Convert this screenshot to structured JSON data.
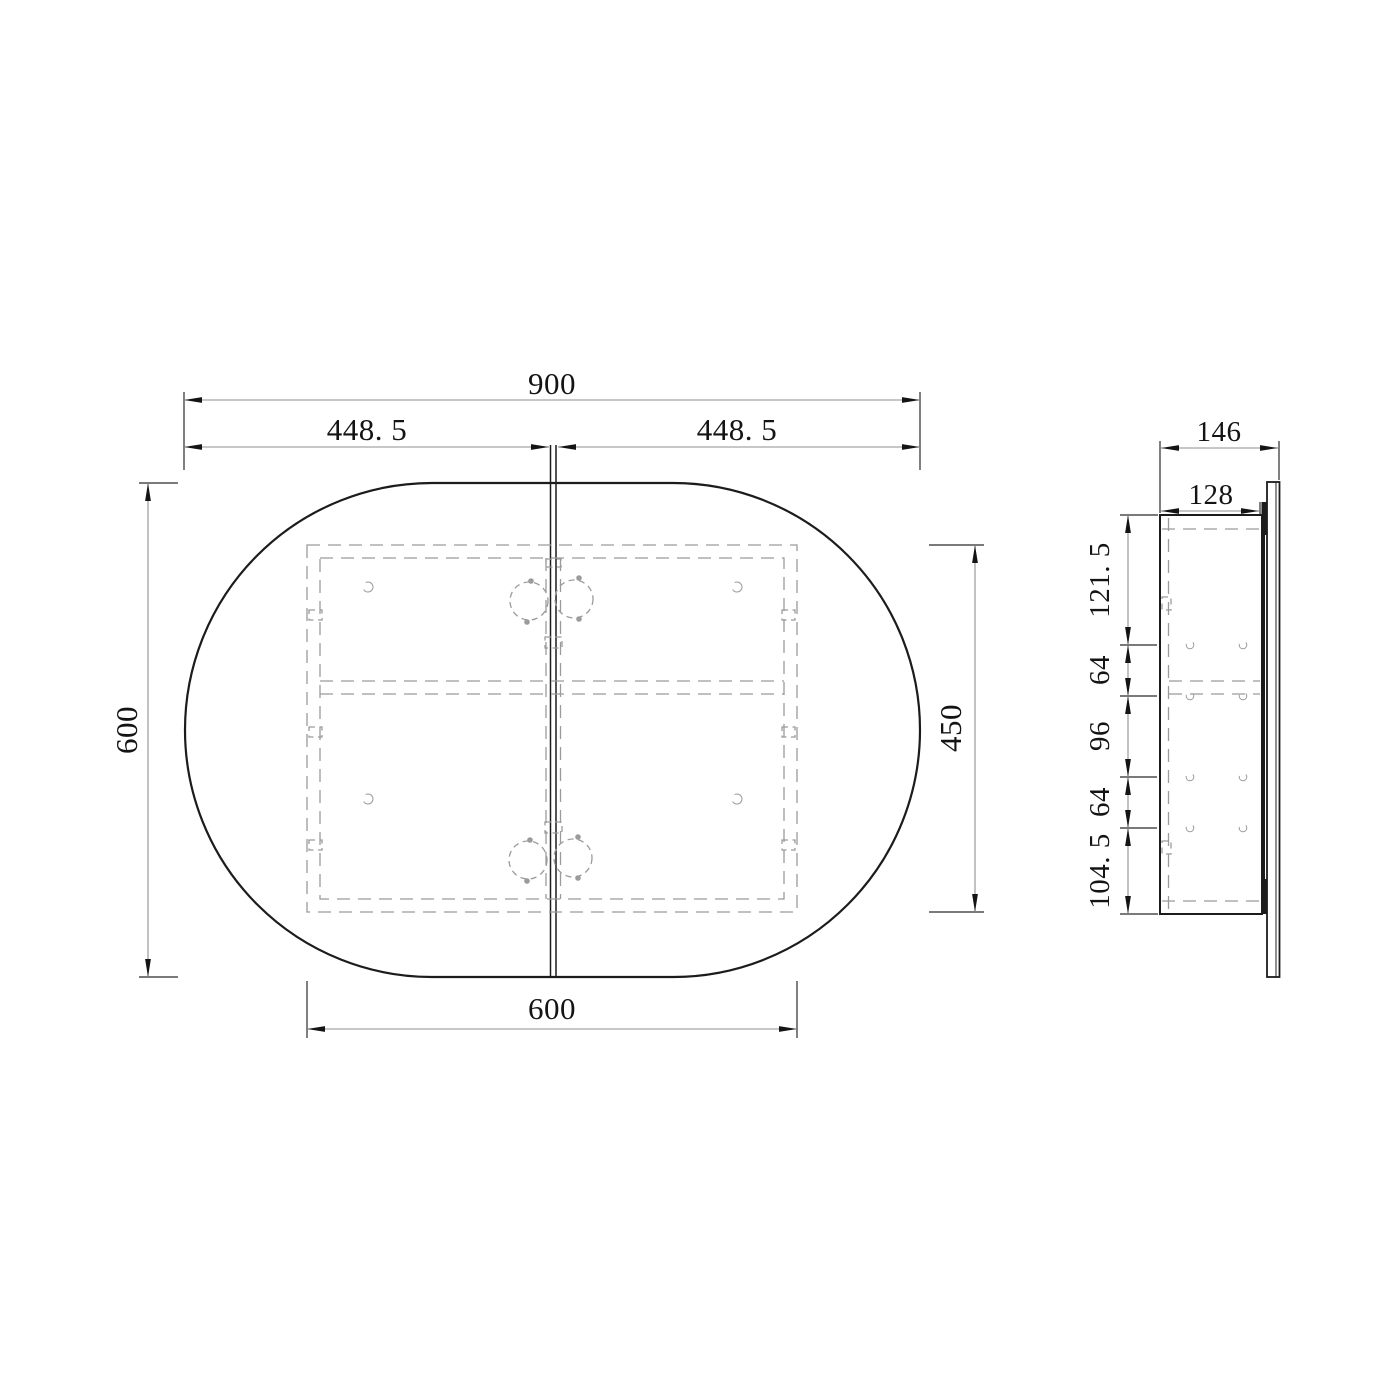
{
  "front_view": {
    "overall_width": "900",
    "left_door_width": "448. 5",
    "right_door_width": "448. 5",
    "overall_height": "600",
    "cabinet_height": "450",
    "cabinet_width": "600"
  },
  "side_view": {
    "overall_depth": "146",
    "cabinet_depth": "128",
    "height_segments": [
      "121. 5",
      "64",
      "96",
      "64",
      "104. 5"
    ]
  },
  "colors": {
    "background": "#ffffff",
    "object_line": "#1c1c1c",
    "hidden_line": "#9b9b9b",
    "dimension_line": "#8f8f8f",
    "text": "#141414"
  }
}
